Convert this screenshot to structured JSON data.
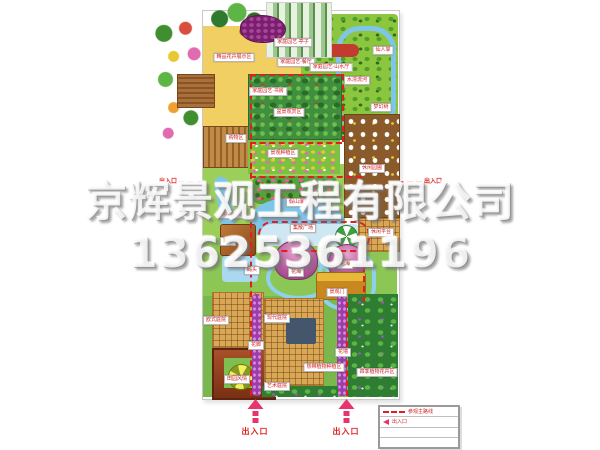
{
  "watermark": {
    "company": "京辉景观工程有限公司",
    "phone": "13625361196"
  },
  "legend": {
    "rows": [
      {
        "symbol": "dashed-line",
        "label": "参观主路线"
      },
      {
        "symbol": "arrow",
        "label": "出入口"
      },
      {
        "symbol": "",
        "label": ""
      },
      {
        "symbol": "",
        "label": ""
      }
    ]
  },
  "entrances": {
    "bottom": [
      {
        "label": "出入口",
        "x": 255
      },
      {
        "label": "出入口",
        "x": 346
      }
    ],
    "sides": [
      {
        "label": "出入口",
        "x": 168,
        "y": 176
      },
      {
        "label": "出入口",
        "x": 433,
        "y": 176
      }
    ]
  },
  "map": {
    "zones": [
      {
        "name": "lawn-mid-west",
        "x": 203,
        "y": 164,
        "w": 142,
        "h": 76,
        "bg": "#9ccf5a"
      },
      {
        "name": "lawn-south-band",
        "x": 203,
        "y": 238,
        "w": 194,
        "h": 60,
        "bg": "#8cc755"
      },
      {
        "name": "lawn-bottom",
        "x": 203,
        "y": 296,
        "w": 194,
        "h": 101,
        "bg": "#7ab84d"
      },
      {
        "name": "yellow-path-north",
        "x": 203,
        "y": 26,
        "w": 98,
        "h": 48,
        "bg": "#f2cf63"
      },
      {
        "name": "yellow-path-west",
        "x": 203,
        "y": 26,
        "w": 46,
        "h": 140,
        "bg": "#f2cf63"
      },
      {
        "name": "forest-northeast",
        "x": 301,
        "y": 14,
        "w": 97,
        "h": 122,
        "cls": "forest-light"
      },
      {
        "name": "stream-loop",
        "x": 336,
        "y": 26,
        "w": 50,
        "h": 94,
        "cls": "stream-loop",
        "r": "24px"
      },
      {
        "name": "red-flower-hedge",
        "x": 313,
        "y": 44,
        "w": 46,
        "h": 13,
        "bg": "#c23b2e",
        "r": "7px"
      },
      {
        "name": "greenhouse-photo",
        "x": 266,
        "y": 2,
        "w": 64,
        "h": 54,
        "cls": "photo-greenhouse"
      },
      {
        "name": "tree-spill-top",
        "x": 208,
        "y": 2,
        "w": 58,
        "h": 42,
        "cls": "spill-green"
      },
      {
        "name": "flower-spill-west",
        "x": 152,
        "y": 18,
        "w": 54,
        "h": 128,
        "cls": "spill-flowers"
      },
      {
        "name": "grape-arbor",
        "x": 240,
        "y": 15,
        "w": 44,
        "h": 26,
        "cls": "grape",
        "r": "45% 55% 50% 50%"
      },
      {
        "name": "pergola-photo",
        "x": 177,
        "y": 74,
        "w": 36,
        "h": 32,
        "cls": "photo-wood"
      },
      {
        "name": "shelf-photo",
        "x": 203,
        "y": 126,
        "w": 46,
        "h": 40,
        "cls": "photo-wood2"
      },
      {
        "name": "display-lawn",
        "x": 248,
        "y": 74,
        "w": 92,
        "h": 64,
        "cls": "lawn-photo"
      },
      {
        "name": "planting-band",
        "x": 248,
        "y": 140,
        "w": 92,
        "h": 34,
        "cls": "flower-band"
      },
      {
        "name": "leisure-plot",
        "x": 344,
        "y": 114,
        "w": 54,
        "h": 102,
        "cls": "plot-flowers"
      },
      {
        "name": "rockery",
        "x": 252,
        "y": 176,
        "w": 86,
        "h": 28,
        "cls": "rockery"
      },
      {
        "name": "pond",
        "x": 252,
        "y": 198,
        "w": 92,
        "h": 44,
        "bg": "#7fc5e8",
        "r": "45% 55% 50% 40%"
      },
      {
        "name": "west-stream",
        "x": 222,
        "y": 176,
        "w": 14,
        "h": 104,
        "bg": "#7fc5e8",
        "r": "10px",
        "rot": -10
      },
      {
        "name": "plaza",
        "x": 260,
        "y": 224,
        "w": 104,
        "h": 22,
        "bg": "#cfe7f3",
        "r": "12px"
      },
      {
        "name": "deck-east",
        "x": 358,
        "y": 218,
        "w": 40,
        "h": 32,
        "cls": "deck"
      },
      {
        "name": "parasol",
        "x": 335,
        "y": 225,
        "w": 21,
        "h": 21,
        "cls": "pinwheel"
      },
      {
        "name": "teahouse",
        "x": 220,
        "y": 224,
        "w": 34,
        "h": 30,
        "cls": "roof-brown"
      },
      {
        "name": "waterfall-photo",
        "x": 222,
        "y": 256,
        "w": 36,
        "h": 26,
        "bg": "#a9d8ef",
        "r": "4px"
      },
      {
        "name": "path-loop-1",
        "x": 266,
        "y": 256,
        "w": 58,
        "h": 36,
        "cls": "blue-loop",
        "r": "50%"
      },
      {
        "name": "path-loop-2",
        "x": 318,
        "y": 250,
        "w": 50,
        "h": 52,
        "cls": "blue-loop",
        "r": "40%"
      },
      {
        "name": "flower-hill-1",
        "x": 274,
        "y": 240,
        "w": 42,
        "h": 38,
        "cls": "mound"
      },
      {
        "name": "flower-hill-2",
        "x": 328,
        "y": 244,
        "w": 36,
        "h": 34,
        "cls": "mound"
      },
      {
        "name": "garden-gate",
        "x": 316,
        "y": 272,
        "w": 48,
        "h": 26,
        "cls": "gate"
      },
      {
        "name": "deck-west",
        "x": 212,
        "y": 292,
        "w": 50,
        "h": 54,
        "cls": "deck"
      },
      {
        "name": "country-pavilion",
        "x": 212,
        "y": 348,
        "w": 60,
        "h": 48,
        "cls": "roof-dark"
      },
      {
        "name": "pavilion-court",
        "x": 224,
        "y": 358,
        "w": 36,
        "h": 30,
        "bg": "#7fbf4f"
      },
      {
        "name": "pinwheel-tree",
        "x": 228,
        "y": 364,
        "w": 24,
        "h": 24,
        "cls": "pinwheel-y"
      },
      {
        "name": "deck-mid",
        "x": 264,
        "y": 298,
        "w": 58,
        "h": 86,
        "cls": "deck"
      },
      {
        "name": "outdoor-kitchen",
        "x": 286,
        "y": 318,
        "w": 30,
        "h": 26,
        "bg": "#44566b",
        "r": "2px"
      },
      {
        "name": "flower-corridor-strip",
        "x": 252,
        "y": 294,
        "w": 9,
        "h": 102,
        "cls": "purple"
      },
      {
        "name": "flower-wall-strip",
        "x": 337,
        "y": 294,
        "w": 10,
        "h": 102,
        "cls": "purple"
      },
      {
        "name": "forest-southeast",
        "x": 348,
        "y": 294,
        "w": 50,
        "h": 103,
        "cls": "forest-dark"
      },
      {
        "name": "hedge-bottom",
        "x": 262,
        "y": 386,
        "w": 76,
        "h": 11,
        "cls": "forest-dark"
      }
    ],
    "labels": [
      {
        "text": "精品花卉展示区",
        "x": 234,
        "y": 57
      },
      {
        "text": "家庭园艺·亭子",
        "x": 293,
        "y": 42
      },
      {
        "text": "家庭园艺·餐厅",
        "x": 296,
        "y": 62
      },
      {
        "text": "家庭园艺·山水厅",
        "x": 331,
        "y": 67
      },
      {
        "text": "家庭园艺·书房",
        "x": 268,
        "y": 91
      },
      {
        "text": "仙人掌",
        "x": 383,
        "y": 50
      },
      {
        "text": "水漂流河",
        "x": 357,
        "y": 80
      },
      {
        "text": "梦幻树",
        "x": 381,
        "y": 107
      },
      {
        "text": "购物区",
        "x": 236,
        "y": 138
      },
      {
        "text": "盆景观赏区",
        "x": 289,
        "y": 112
      },
      {
        "text": "景观种植区",
        "x": 283,
        "y": 153
      },
      {
        "text": "休闲园圃",
        "x": 372,
        "y": 168
      },
      {
        "text": "假山瀑布",
        "x": 299,
        "y": 202
      },
      {
        "text": "缓水戏流",
        "x": 231,
        "y": 214
      },
      {
        "text": "集散广场",
        "x": 303,
        "y": 228
      },
      {
        "text": "休闲平台",
        "x": 381,
        "y": 232
      },
      {
        "text": "茶室",
        "x": 228,
        "y": 241
      },
      {
        "text": "码头",
        "x": 252,
        "y": 270
      },
      {
        "text": "花海",
        "x": 296,
        "y": 272
      },
      {
        "text": "花海",
        "x": 345,
        "y": 264
      },
      {
        "text": "景观门",
        "x": 337,
        "y": 292
      },
      {
        "text": "欧式庭院",
        "x": 216,
        "y": 320
      },
      {
        "text": "现代庭院",
        "x": 277,
        "y": 318
      },
      {
        "text": "花廊",
        "x": 256,
        "y": 345
      },
      {
        "text": "花墙",
        "x": 343,
        "y": 352
      },
      {
        "text": "田园风情",
        "x": 237,
        "y": 379
      },
      {
        "text": "艺术庭院",
        "x": 277,
        "y": 386
      },
      {
        "text": "热带植物种植区",
        "x": 324,
        "y": 367
      },
      {
        "text": "四季植物花卉区",
        "x": 377,
        "y": 372
      }
    ],
    "route": [
      {
        "type": "h",
        "x": 250,
        "y": 74,
        "len": 92
      },
      {
        "type": "v",
        "x": 250,
        "y": 74,
        "len": 322
      },
      {
        "type": "v",
        "x": 342,
        "y": 74,
        "len": 68
      },
      {
        "type": "h",
        "x": 250,
        "y": 142,
        "len": 92
      },
      {
        "type": "h",
        "x": 250,
        "y": 176,
        "len": 112
      },
      {
        "type": "loop",
        "x": 258,
        "y": 221,
        "w": 108,
        "h": 27
      },
      {
        "type": "v",
        "x": 363,
        "y": 246,
        "len": 56
      },
      {
        "type": "v",
        "x": 346,
        "y": 302,
        "len": 94
      },
      {
        "type": "h",
        "x": 178,
        "y": 181,
        "len": 25
      },
      {
        "type": "h",
        "x": 398,
        "y": 181,
        "len": 24
      }
    ]
  }
}
